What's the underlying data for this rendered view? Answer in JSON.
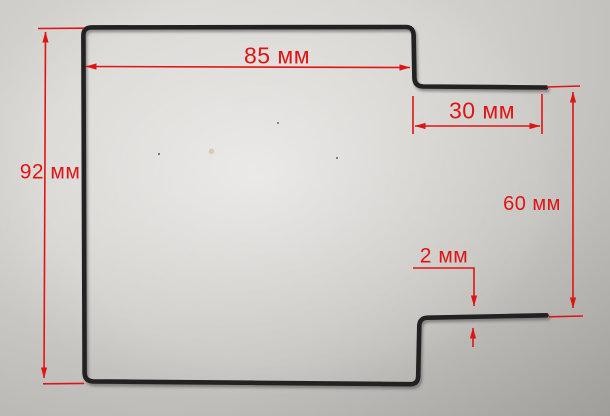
{
  "scene": {
    "description": "Photo of a black bent wire element on a gray surface with red dimension annotations",
    "object": "bent-wire-element",
    "units": "мм",
    "background_color": "#d3d1cd",
    "wire_color": "#232323",
    "annotation_color": "#df1515"
  },
  "annotations": {
    "top_width": {
      "label": "85 мм",
      "value": 85,
      "unit": "мм"
    },
    "top_arm": {
      "label": "30 мм",
      "value": 30,
      "unit": "мм"
    },
    "left_height": {
      "label": "92 мм",
      "value": 92,
      "unit": "мм"
    },
    "right_height": {
      "label": "60 мм",
      "value": 60,
      "unit": "мм"
    },
    "wire_diameter": {
      "label": "2 мм",
      "value": 2,
      "unit": "мм"
    }
  }
}
